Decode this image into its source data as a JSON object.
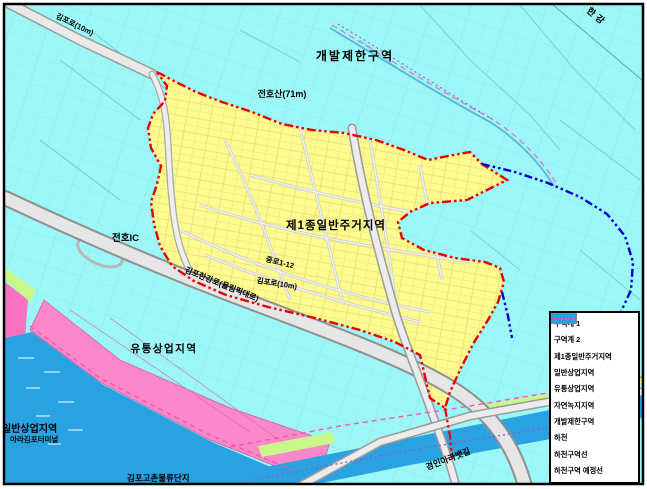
{
  "map": {
    "labels": {
      "han_river": "한강",
      "greenbelt_zone": "개발제한구역",
      "mountain_peak": "전호산(71m)",
      "residential_zone": "제1종일반주거지역",
      "interchange": "전호IC",
      "highway_road": "김포한강로(올림픽대로)",
      "road_10m": "김포로(10m)",
      "road_10m_nw": "김포로(10m)",
      "road_segment": "중로1-12",
      "distribution_commercial_zone": "유통상업지역",
      "general_commercial_zone": "일반상업지역",
      "ara_terminal": "아라김포터미널",
      "logistics_complex": "김포고촌물류단지",
      "ara_canal": "경인아라뱃길"
    },
    "legend": {
      "items": [
        {
          "label": "구역계 1",
          "type": "line",
          "style": "dashdot",
          "color": "#e60000"
        },
        {
          "label": "구역계 2",
          "type": "line",
          "style": "dashdot",
          "color": "#0000cd"
        },
        {
          "label": "제1종일반주거지역",
          "type": "fill",
          "color": "#fdfa8e"
        },
        {
          "label": "일반상업지역",
          "type": "fill",
          "color": "#f972c2"
        },
        {
          "label": "유통상업지역",
          "type": "fill",
          "color": "#f987c9"
        },
        {
          "label": "자연녹지지역",
          "type": "fill",
          "color": "#c9f78a"
        },
        {
          "label": "개발제한구역",
          "type": "fill",
          "color": "#9df7f7"
        },
        {
          "label": "하천",
          "type": "fill",
          "color": "#2aa2e2"
        },
        {
          "label": "하천구역선",
          "type": "line",
          "style": "dashed",
          "color": "#f05aaa"
        },
        {
          "label": "하천구역 예정선",
          "type": "line",
          "style": "dotted",
          "color": "#8a5ad0"
        }
      ]
    },
    "colors": {
      "background_greenbelt": "#9df7f7",
      "residential": "#fdfa8e",
      "river": "#2aa2e2",
      "commercial_pink": "#f987c9",
      "natural_green": "#c9f78a",
      "boundary_1": "#e60000",
      "boundary_2": "#0000cd"
    }
  }
}
